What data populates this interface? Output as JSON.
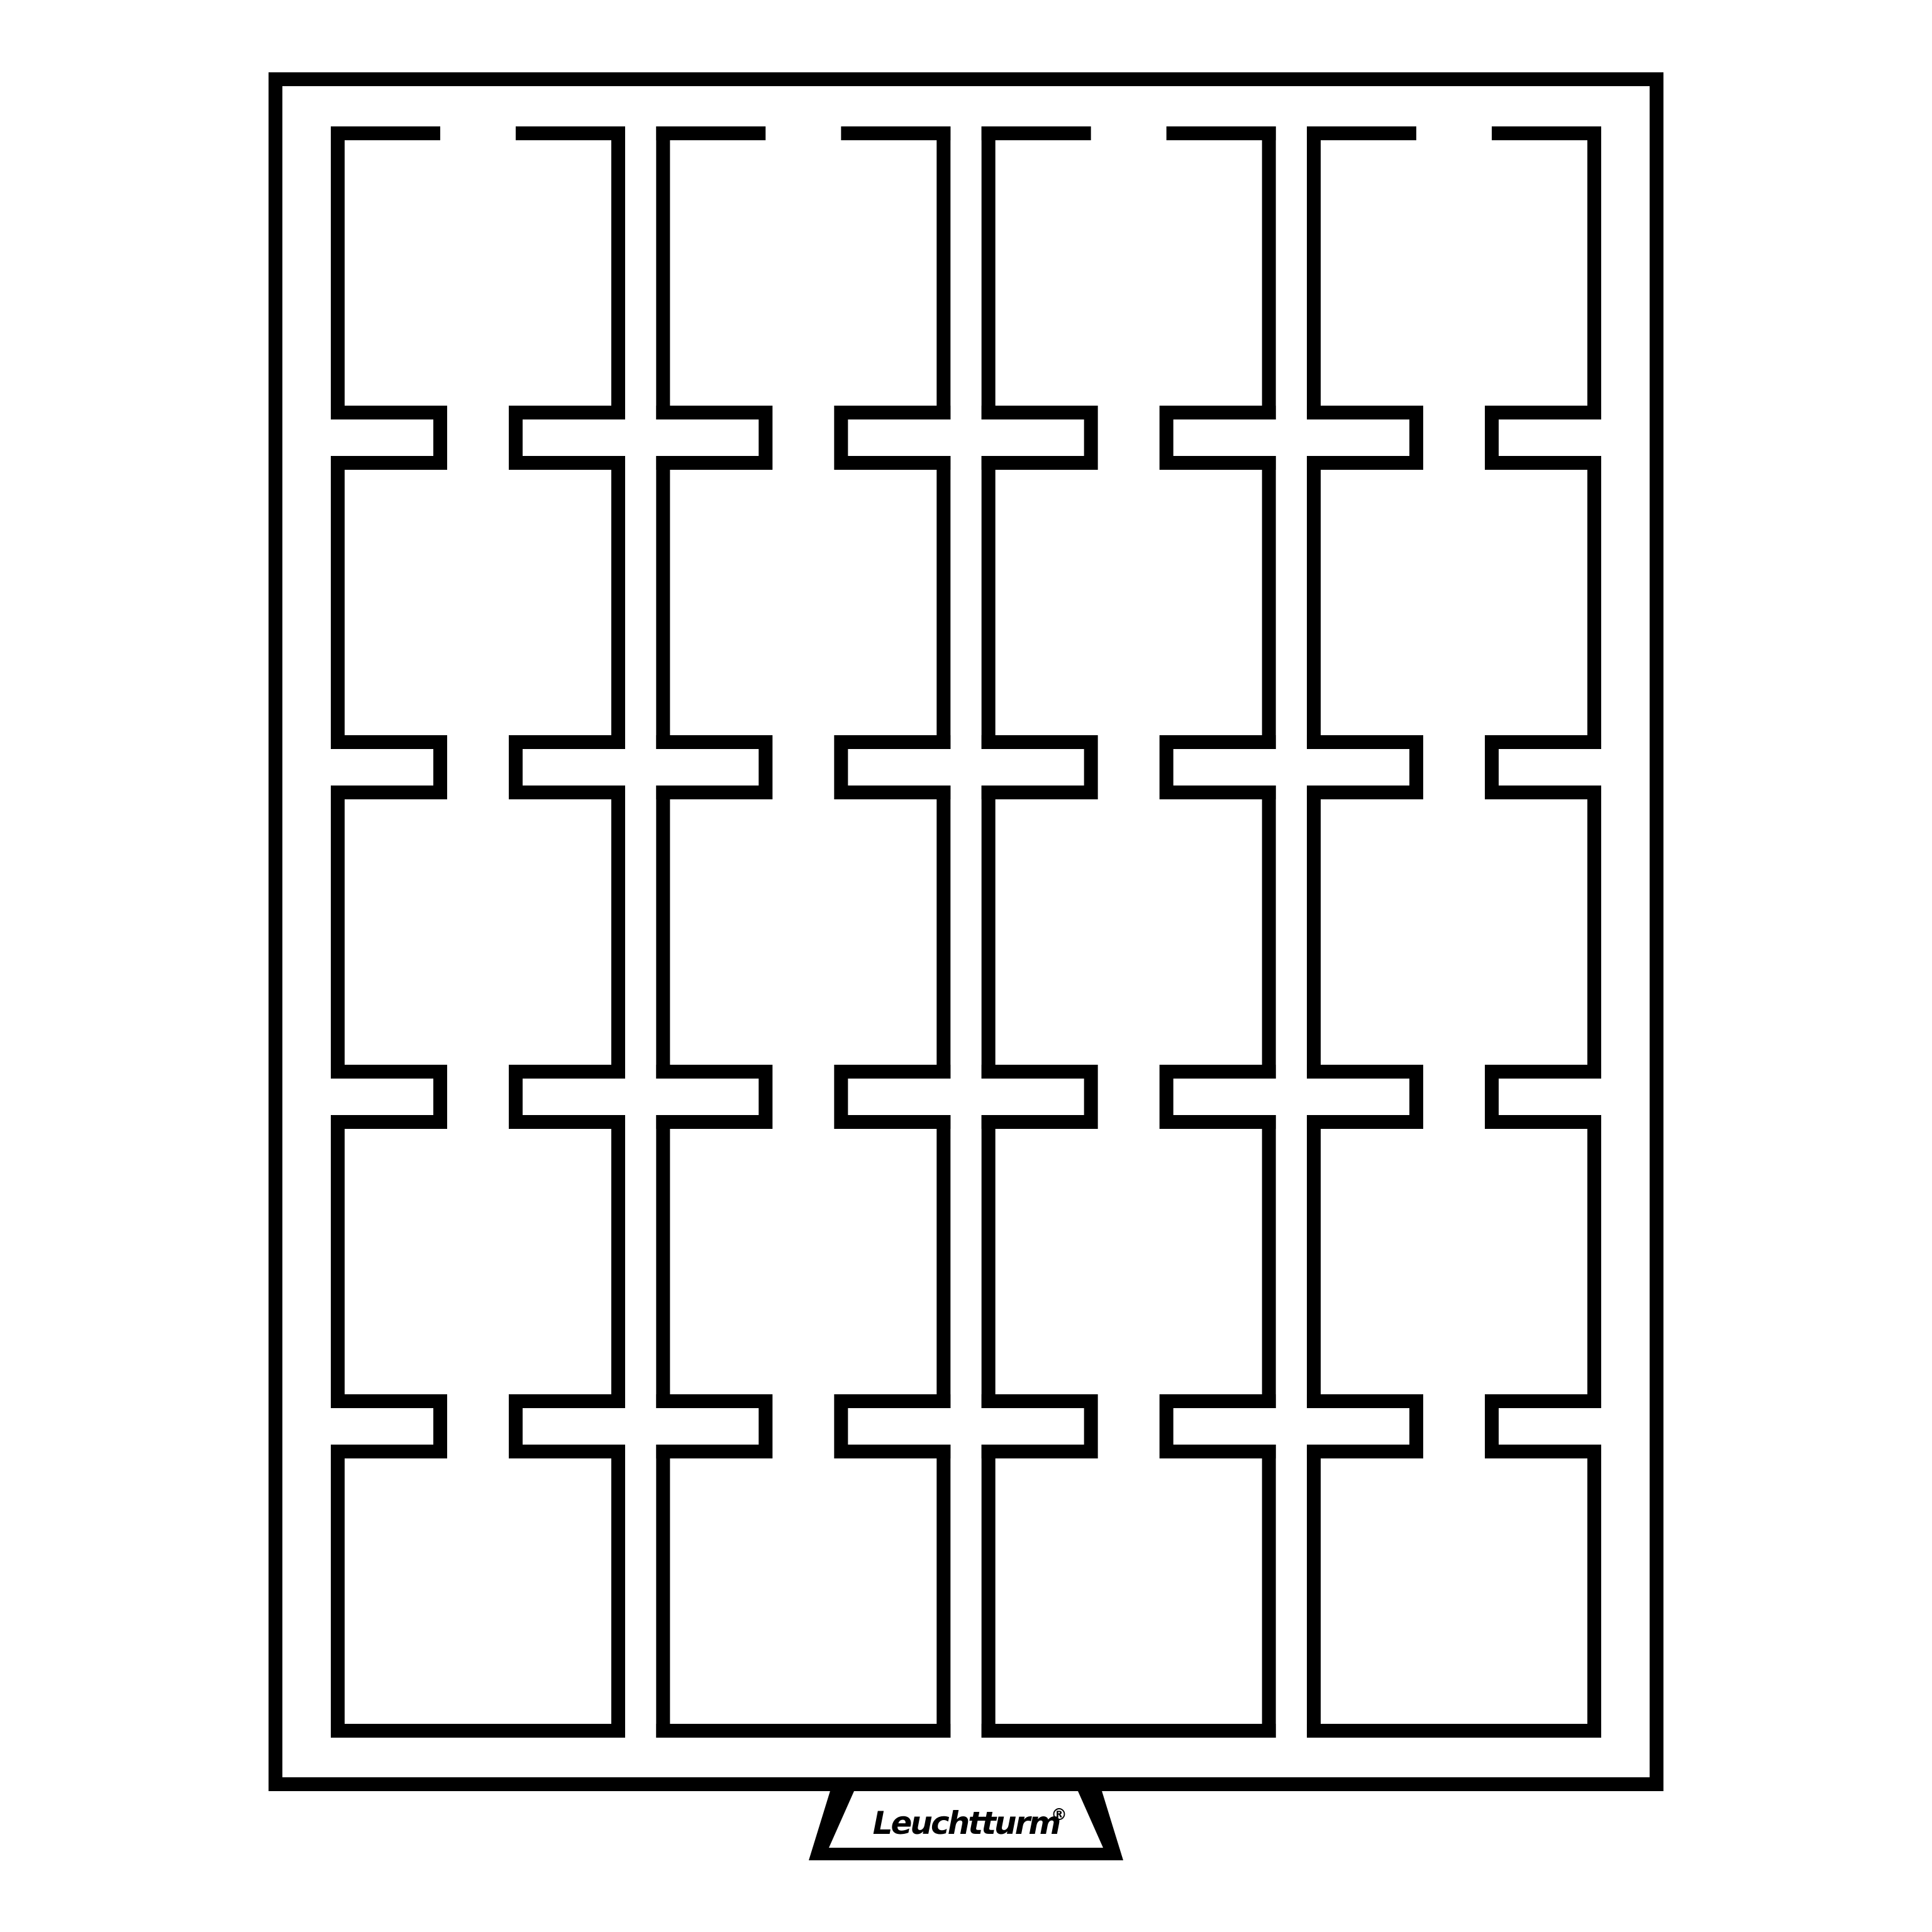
{
  "diagram": {
    "kind": "coin-box-tray-line-drawing",
    "brand": "Leuchtturm",
    "registered_mark": "®",
    "grid": {
      "columns": 4,
      "rows": 5,
      "compartments": 20
    },
    "colors": {
      "line": "#000000",
      "background": "#ffffff"
    }
  }
}
